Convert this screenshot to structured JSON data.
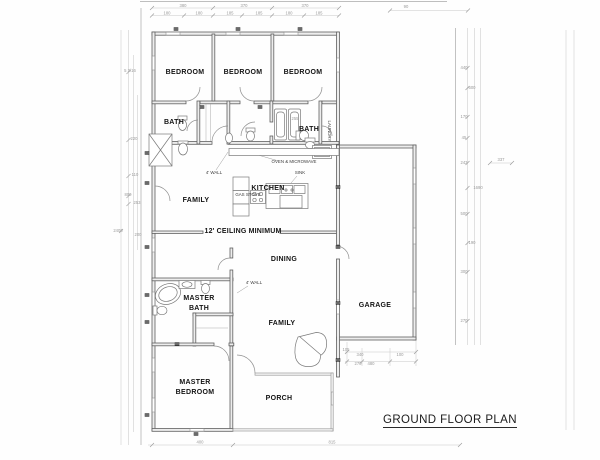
{
  "title": "GROUND FLOOR PLAN",
  "colors": {
    "wall": "#5f5f5f",
    "dimension_line": "#c8c8c8",
    "label_text": "#141414",
    "dimension_text": "#9a9a9a"
  },
  "labels": [
    {
      "name": "room-label-bedroom-1",
      "kind": "room",
      "text": "BEDROOM",
      "x": 185,
      "y": 74
    },
    {
      "name": "room-label-bedroom-2",
      "kind": "room",
      "text": "BEDROOM",
      "x": 243,
      "y": 74
    },
    {
      "name": "room-label-bedroom-3",
      "kind": "room",
      "text": "BEDROOM",
      "x": 303,
      "y": 74
    },
    {
      "name": "room-label-bath-1",
      "kind": "room",
      "text": "BATH",
      "x": 174,
      "y": 124
    },
    {
      "name": "room-label-bath-2",
      "kind": "room",
      "text": "BATH",
      "x": 309,
      "y": 131
    },
    {
      "name": "room-label-kitchen",
      "kind": "room",
      "text": "KITCHEN",
      "x": 268,
      "y": 190
    },
    {
      "name": "room-label-family-upper",
      "kind": "room",
      "text": "FAMILY",
      "x": 196,
      "y": 202
    },
    {
      "name": "ceiling-note",
      "kind": "note",
      "text": "12' CEILING MINIMUM",
      "x": 243,
      "y": 233
    },
    {
      "name": "room-label-dining",
      "kind": "room",
      "text": "DINING",
      "x": 284,
      "y": 261
    },
    {
      "name": "room-label-master-bath-line1",
      "kind": "room",
      "text": "MASTER",
      "x": 199,
      "y": 300
    },
    {
      "name": "room-label-master-bath-line2",
      "kind": "room",
      "text": "BATH",
      "x": 199,
      "y": 310
    },
    {
      "name": "room-label-family-lower",
      "kind": "room",
      "text": "FAMILY",
      "x": 282,
      "y": 325
    },
    {
      "name": "room-label-garage",
      "kind": "room",
      "text": "GARAGE",
      "x": 375,
      "y": 307
    },
    {
      "name": "room-label-master-bedroom-line1",
      "kind": "room",
      "text": "MASTER",
      "x": 195,
      "y": 384
    },
    {
      "name": "room-label-master-bedroom-line2",
      "kind": "room",
      "text": "BEDROOM",
      "x": 195,
      "y": 394
    },
    {
      "name": "room-label-porch",
      "kind": "room",
      "text": "PORCH",
      "x": 279,
      "y": 400
    },
    {
      "name": "note-oven-microwave",
      "kind": "small",
      "text": "OVEN & MICROWAVE",
      "x": 294,
      "y": 163
    },
    {
      "name": "note-sink",
      "kind": "small",
      "text": "SINK",
      "x": 300,
      "y": 174
    },
    {
      "name": "note-gas-stove",
      "kind": "small",
      "text": "GAS STOVE",
      "x": 248,
      "y": 196
    },
    {
      "name": "note-4ft-wall-kitchen",
      "kind": "small",
      "text": "4' WALL",
      "x": 214,
      "y": 174
    },
    {
      "name": "note-4ft-wall-dining",
      "kind": "small",
      "text": "4' WALL",
      "x": 254,
      "y": 284
    },
    {
      "name": "note-laundry",
      "kind": "small",
      "text": "LAUNDRY",
      "x": 328,
      "y": 131,
      "rot": 90
    },
    {
      "name": "dim-label",
      "kind": "dim",
      "text": "380",
      "x": 183,
      "y": 7
    },
    {
      "name": "dim-label",
      "kind": "dim",
      "text": "370",
      "x": 244,
      "y": 7
    },
    {
      "name": "dim-label",
      "kind": "dim",
      "text": "370",
      "x": 305,
      "y": 7
    },
    {
      "name": "dim-label",
      "kind": "dim",
      "text": "90",
      "x": 406,
      "y": 8
    },
    {
      "name": "dim-label",
      "kind": "dim",
      "text": "180",
      "x": 167,
      "y": 14.5
    },
    {
      "name": "dim-label",
      "kind": "dim",
      "text": "180",
      "x": 199,
      "y": 14.5
    },
    {
      "name": "dim-label",
      "kind": "dim",
      "text": "185",
      "x": 230,
      "y": 14.5
    },
    {
      "name": "dim-label",
      "kind": "dim",
      "text": "185",
      "x": 259,
      "y": 14.5
    },
    {
      "name": "dim-label",
      "kind": "dim",
      "text": "180",
      "x": 289,
      "y": 14.5
    },
    {
      "name": "dim-label",
      "kind": "dim",
      "text": "185",
      "x": 319,
      "y": 14.5
    },
    {
      "name": "dim-label",
      "kind": "dim",
      "text": "5 3/16",
      "x": 130,
      "y": 72
    },
    {
      "name": "dim-label",
      "kind": "dim",
      "text": "220",
      "x": 134,
      "y": 140
    },
    {
      "name": "dim-label",
      "kind": "dim",
      "text": "110",
      "x": 135,
      "y": 176
    },
    {
      "name": "dim-label",
      "kind": "dim",
      "text": "800",
      "x": 128,
      "y": 196
    },
    {
      "name": "dim-label",
      "kind": "dim",
      "text": "253",
      "x": 137,
      "y": 204
    },
    {
      "name": "dim-label",
      "kind": "dim",
      "text": "2400",
      "x": 118,
      "y": 232
    },
    {
      "name": "dim-label",
      "kind": "dim",
      "text": "200",
      "x": 138,
      "y": 236
    },
    {
      "name": "dim-label",
      "kind": "dim",
      "text": "440",
      "x": 464,
      "y": 69
    },
    {
      "name": "dim-label",
      "kind": "dim",
      "text": "600",
      "x": 472,
      "y": 89
    },
    {
      "name": "dim-label",
      "kind": "dim",
      "text": "170",
      "x": 464,
      "y": 118
    },
    {
      "name": "dim-label",
      "kind": "dim",
      "text": "45",
      "x": 464,
      "y": 139
    },
    {
      "name": "dim-label",
      "kind": "dim",
      "text": "243",
      "x": 464,
      "y": 164
    },
    {
      "name": "dim-label",
      "kind": "dim",
      "text": "1690",
      "x": 478,
      "y": 189
    },
    {
      "name": "dim-label",
      "kind": "dim",
      "text": "337",
      "x": 501,
      "y": 161
    },
    {
      "name": "dim-label",
      "kind": "dim",
      "text": "500",
      "x": 464,
      "y": 215
    },
    {
      "name": "dim-label",
      "kind": "dim",
      "text": "190",
      "x": 472,
      "y": 244
    },
    {
      "name": "dim-label",
      "kind": "dim",
      "text": "300",
      "x": 464,
      "y": 273
    },
    {
      "name": "dim-label",
      "kind": "dim",
      "text": "270",
      "x": 464,
      "y": 322
    },
    {
      "name": "dim-label",
      "kind": "dim",
      "text": "255",
      "x": 295,
      "y": 120
    },
    {
      "name": "dim-label",
      "kind": "dim",
      "text": "105",
      "x": 346,
      "y": 351
    },
    {
      "name": "dim-label",
      "kind": "dim",
      "text": "340",
      "x": 360,
      "y": 356
    },
    {
      "name": "dim-label",
      "kind": "dim",
      "text": "100",
      "x": 400,
      "y": 356
    },
    {
      "name": "dim-label",
      "kind": "dim",
      "text": "270",
      "x": 358,
      "y": 365
    },
    {
      "name": "dim-label",
      "kind": "dim",
      "text": "480",
      "x": 371,
      "y": 365
    },
    {
      "name": "dim-label",
      "kind": "dim",
      "text": "400",
      "x": 200,
      "y": 443.5
    },
    {
      "name": "dim-label",
      "kind": "dim",
      "text": "815",
      "x": 332,
      "y": 443.5
    }
  ]
}
